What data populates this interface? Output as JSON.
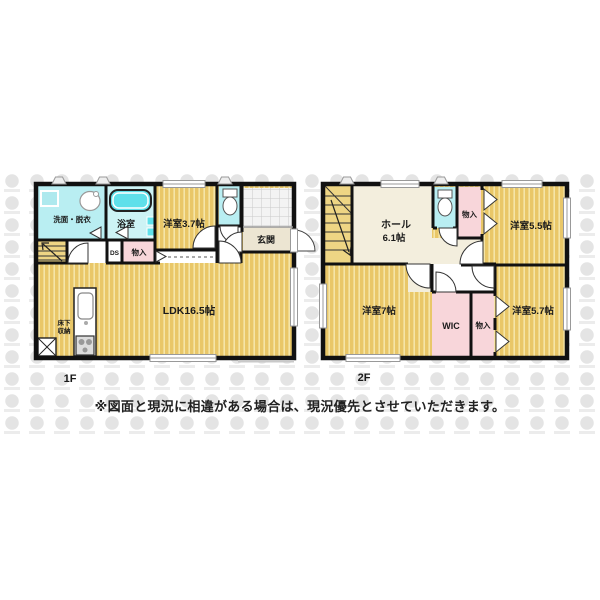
{
  "floors": [
    {
      "label": "1F",
      "rooms": {
        "washroom": "洗面・脱衣",
        "bathroom": "浴室",
        "western_room": "洋室3.7帖",
        "entrance": "玄関",
        "duct_space": "DS",
        "closet": "物入",
        "ldk": "LDK16.5帖",
        "underfloor_storage_line1": "床下",
        "underfloor_storage_line2": "収納"
      }
    },
    {
      "label": "2F",
      "rooms": {
        "hall_name": "ホール",
        "hall_area": "6.1帖",
        "closet_upper": "物入",
        "western_room_55": "洋室5.5帖",
        "western_room_7": "洋室7帖",
        "wic": "WIC",
        "closet_lower": "物入",
        "western_room_57": "洋室5.7帖"
      }
    }
  ],
  "disclaimer": "※図面と現況に相違がある場合は、現況優先とさせていただきます。",
  "colors": {
    "floor_yellow": "#e9c768",
    "floor_stripe": "#f5e5a8",
    "stairs_yellow": "#eed584",
    "wet_area_cyan": "#b9eef2",
    "bathroom_cyan": "#cdf3f5",
    "bathtub_cyan": "#5fe0ea",
    "closet_pink": "#f8d6da",
    "hall_cream": "#f3eedd",
    "entrance_beige": "#ece5d2",
    "wall_black": "#111111",
    "watermark_gray": "#e4e4e4"
  }
}
